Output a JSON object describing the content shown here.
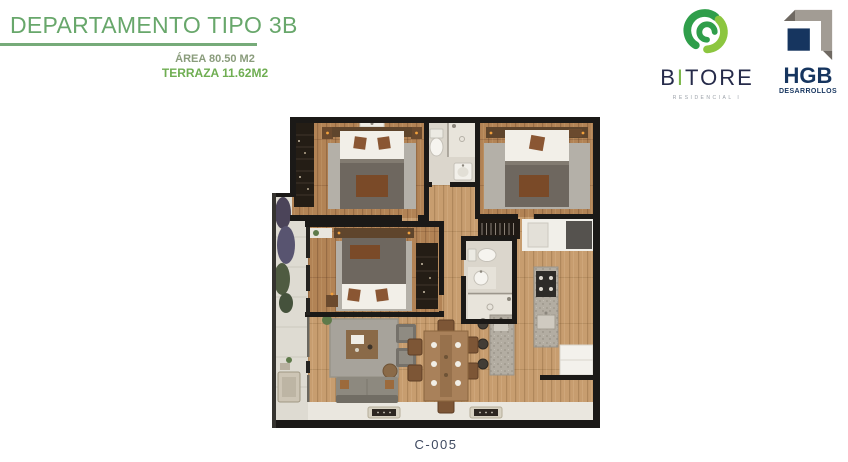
{
  "page": {
    "background": "#ffffff"
  },
  "header": {
    "title": "DEPARTAMENTO TIPO 3B",
    "title_color": "#68a76b",
    "underline_color": "#76ab79",
    "area": {
      "line1": "ÁREA 80.50 M2",
      "line1_color": "#8a9c7c",
      "line2": "TERRAZA 11.62M2",
      "line2_color": "#6fae52"
    }
  },
  "logos": {
    "bitore": {
      "wordmark_prefix": "B",
      "wordmark_accent": "I",
      "wordmark_suffix": "TORE",
      "tagline": "RESIDENCIAL I",
      "navy": "#262b4a",
      "accent_green": "#7ab648",
      "leaf_dark": "#2f9e4a",
      "leaf_light": "#8cc63f",
      "tagline_color": "#9aa0a8"
    },
    "hgb": {
      "name": "HGB",
      "tagline": "DESARROLLOS",
      "navy": "#16355f",
      "gray": "#a29c94",
      "gray_dark": "#6f6962"
    }
  },
  "floor_plan": {
    "unit_label": "C-005",
    "unit_label_color": "#3e4960",
    "palette": {
      "wall": "#1b1917",
      "wood_bedroom": "#b28355",
      "wood_living": "#c79d6f",
      "bathroom_tile": "#dbd6cc",
      "terrace_tile": "#dedbd2",
      "rug": "#b4b0a8",
      "blanket": "#6e675f",
      "granite": "#b3ada2"
    }
  }
}
